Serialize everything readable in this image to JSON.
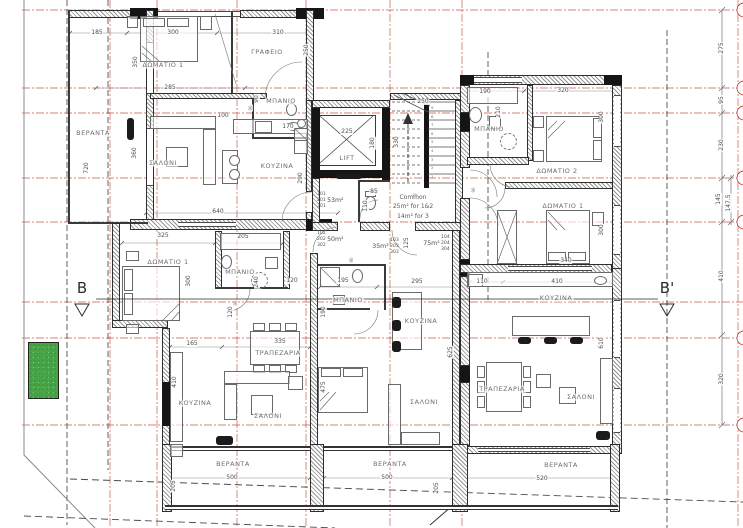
{
  "colors": {
    "grid_red": "#c5392b",
    "wall_dark": "#151515",
    "line_gray": "#5f5f5f",
    "text_gray": "#6e6e6e",
    "planter_green": "#47a447"
  },
  "section": {
    "left_label": "B",
    "right_label": "B'"
  },
  "common_area": {
    "line1": "Common",
    "line2": "25m² for 1&2",
    "line3": "14m² for 3"
  },
  "units": [
    {
      "ids": [
        "101",
        "201",
        "301"
      ],
      "area": "53m²",
      "x": 317,
      "y": 192,
      "side": "right"
    },
    {
      "ids": [
        "102",
        "202",
        "302"
      ],
      "area": "50m²",
      "x": 317,
      "y": 231,
      "side": "right"
    },
    {
      "ids": [
        "103",
        "203",
        "303"
      ],
      "area": "35m²",
      "x": 390,
      "y": 238,
      "side": "left"
    },
    {
      "ids": [
        "104",
        "204",
        "304"
      ],
      "area": "75m²",
      "x": 441,
      "y": 235,
      "side": "left"
    }
  ],
  "rooms": [
    [
      "ΔΩΜΑΤΙΟ 1",
      163,
      65,
      0
    ],
    [
      "ΓΡΑΦΕΙΟ",
      267,
      52,
      0
    ],
    [
      "ΜΠΑΝΙΟ",
      281,
      101,
      0
    ],
    [
      "ΒΕΡΑΝΤΑ",
      93,
      133,
      0
    ],
    [
      "ΣΑΛΟΝΙ",
      163,
      163,
      0
    ],
    [
      "ΚΟΥΖΙΝΑ",
      277,
      166,
      0
    ],
    [
      "LIFT",
      347,
      158,
      0
    ],
    [
      "ΜΠΑΝΙΟ",
      489,
      129,
      0
    ],
    [
      "ΔΩΜΑΤΙΟ 2",
      557,
      171,
      0
    ],
    [
      "ΔΩΜΑΤΙΟ 1",
      563,
      206,
      0
    ],
    [
      "ΔΩΜΑΤΙΟ 1",
      168,
      262,
      0
    ],
    [
      "ΜΠΑΝΙΟ",
      240,
      272,
      0
    ],
    [
      "ΤΡΑΠΕΖΑΡΙΑ",
      278,
      353,
      0
    ],
    [
      "ΚΟΥΖΙΝΑ",
      195,
      403,
      0
    ],
    [
      "ΣΑΛΟΝΙ",
      268,
      416,
      0
    ],
    [
      "ΜΠΑΝΙΟ",
      348,
      300,
      0
    ],
    [
      "ΚΟΥΖΙΝΑ",
      421,
      321,
      0
    ],
    [
      "ΣΑΛΟΝΙ",
      424,
      402,
      0
    ],
    [
      "ΚΟΥΖΙΝΑ",
      556,
      298,
      0
    ],
    [
      "ΤΡΑΠΕΖΑΡΙΑ",
      502,
      389,
      0
    ],
    [
      "ΣΑΛΟΝΙ",
      581,
      397,
      0
    ],
    [
      "ΒΕΡΑΝΤΑ",
      233,
      464,
      0
    ],
    [
      "ΒΕΡΑΝΤΑ",
      390,
      464,
      0
    ],
    [
      "ΒΕΡΑΝΤΑ",
      561,
      465,
      0
    ]
  ],
  "dims": [
    [
      "185",
      97,
      33,
      0,
      0
    ],
    [
      "300",
      173,
      33,
      0,
      0
    ],
    [
      "310",
      278,
      33,
      0,
      0
    ],
    [
      "350",
      136,
      62,
      1,
      0
    ],
    [
      "250",
      307,
      50,
      1,
      0
    ],
    [
      "285",
      170,
      88,
      0,
      0
    ],
    [
      "90",
      257,
      99,
      1,
      0
    ],
    [
      "100",
      223,
      116,
      0,
      0
    ],
    [
      "170",
      288,
      127,
      0,
      0
    ],
    [
      "360",
      135,
      153,
      1,
      0
    ],
    [
      "720",
      87,
      168,
      1,
      0
    ],
    [
      "640",
      218,
      212,
      0,
      0
    ],
    [
      "290",
      301,
      178,
      1,
      0
    ],
    [
      "225",
      347,
      132,
      0,
      0
    ],
    [
      "180",
      373,
      143,
      1,
      0
    ],
    [
      "250",
      423,
      102,
      0,
      0
    ],
    [
      "330",
      397,
      142,
      1,
      0
    ],
    [
      "85",
      374,
      192,
      0,
      0
    ],
    [
      "110",
      366,
      206,
      1,
      0
    ],
    [
      "125",
      407,
      243,
      1,
      0
    ],
    [
      "190",
      485,
      92,
      0,
      0
    ],
    [
      "320",
      563,
      91,
      0,
      0
    ],
    [
      "210",
      499,
      112,
      1,
      0
    ],
    [
      "300",
      602,
      117,
      1,
      0
    ],
    [
      "300",
      602,
      230,
      1,
      0
    ],
    [
      "340",
      566,
      261,
      0,
      0
    ],
    [
      "110",
      482,
      282,
      0,
      0
    ],
    [
      "410",
      557,
      282,
      0,
      0
    ],
    [
      "610",
      602,
      343,
      1,
      0
    ],
    [
      "275",
      722,
      48,
      1,
      0
    ],
    [
      "95",
      722,
      100,
      1,
      0
    ],
    [
      "230",
      722,
      145,
      1,
      0
    ],
    [
      "145",
      719,
      199,
      1,
      0
    ],
    [
      "147.5",
      729,
      203,
      1,
      0
    ],
    [
      "410",
      722,
      276,
      1,
      0
    ],
    [
      "320",
      722,
      379,
      1,
      0
    ],
    [
      "325",
      163,
      236,
      0,
      0
    ],
    [
      "205",
      243,
      237,
      0,
      0
    ],
    [
      "300",
      189,
      281,
      1,
      0
    ],
    [
      "240",
      257,
      282,
      1,
      0
    ],
    [
      "120",
      292,
      281,
      0,
      0
    ],
    [
      "120",
      231,
      312,
      1,
      0
    ],
    [
      "165",
      192,
      344,
      0,
      0
    ],
    [
      "335",
      280,
      342,
      0,
      0
    ],
    [
      "410",
      175,
      382,
      1,
      0
    ],
    [
      "475",
      324,
      387,
      1,
      0
    ],
    [
      "195",
      343,
      281,
      0,
      0
    ],
    [
      "295",
      417,
      282,
      0,
      0
    ],
    [
      "190",
      324,
      312,
      1,
      0
    ],
    [
      "625",
      451,
      352,
      1,
      0
    ],
    [
      "500",
      232,
      478,
      0,
      0
    ],
    [
      "205",
      174,
      486,
      1,
      0
    ],
    [
      "500",
      387,
      478,
      0,
      0
    ],
    [
      "205",
      437,
      488,
      1,
      0
    ],
    [
      "520",
      542,
      479,
      0,
      0
    ],
    [
      "90",
      251,
      108,
      1,
      1
    ],
    [
      "90",
      474,
      190,
      1,
      1
    ],
    [
      "90",
      236,
      303,
      1,
      1
    ],
    [
      "90",
      352,
      260,
      1,
      1
    ]
  ],
  "stairs": {
    "digits": [
      "9",
      "8",
      "7",
      "6",
      "5",
      "4",
      "3",
      "2",
      "1"
    ],
    "count_label": "19"
  }
}
